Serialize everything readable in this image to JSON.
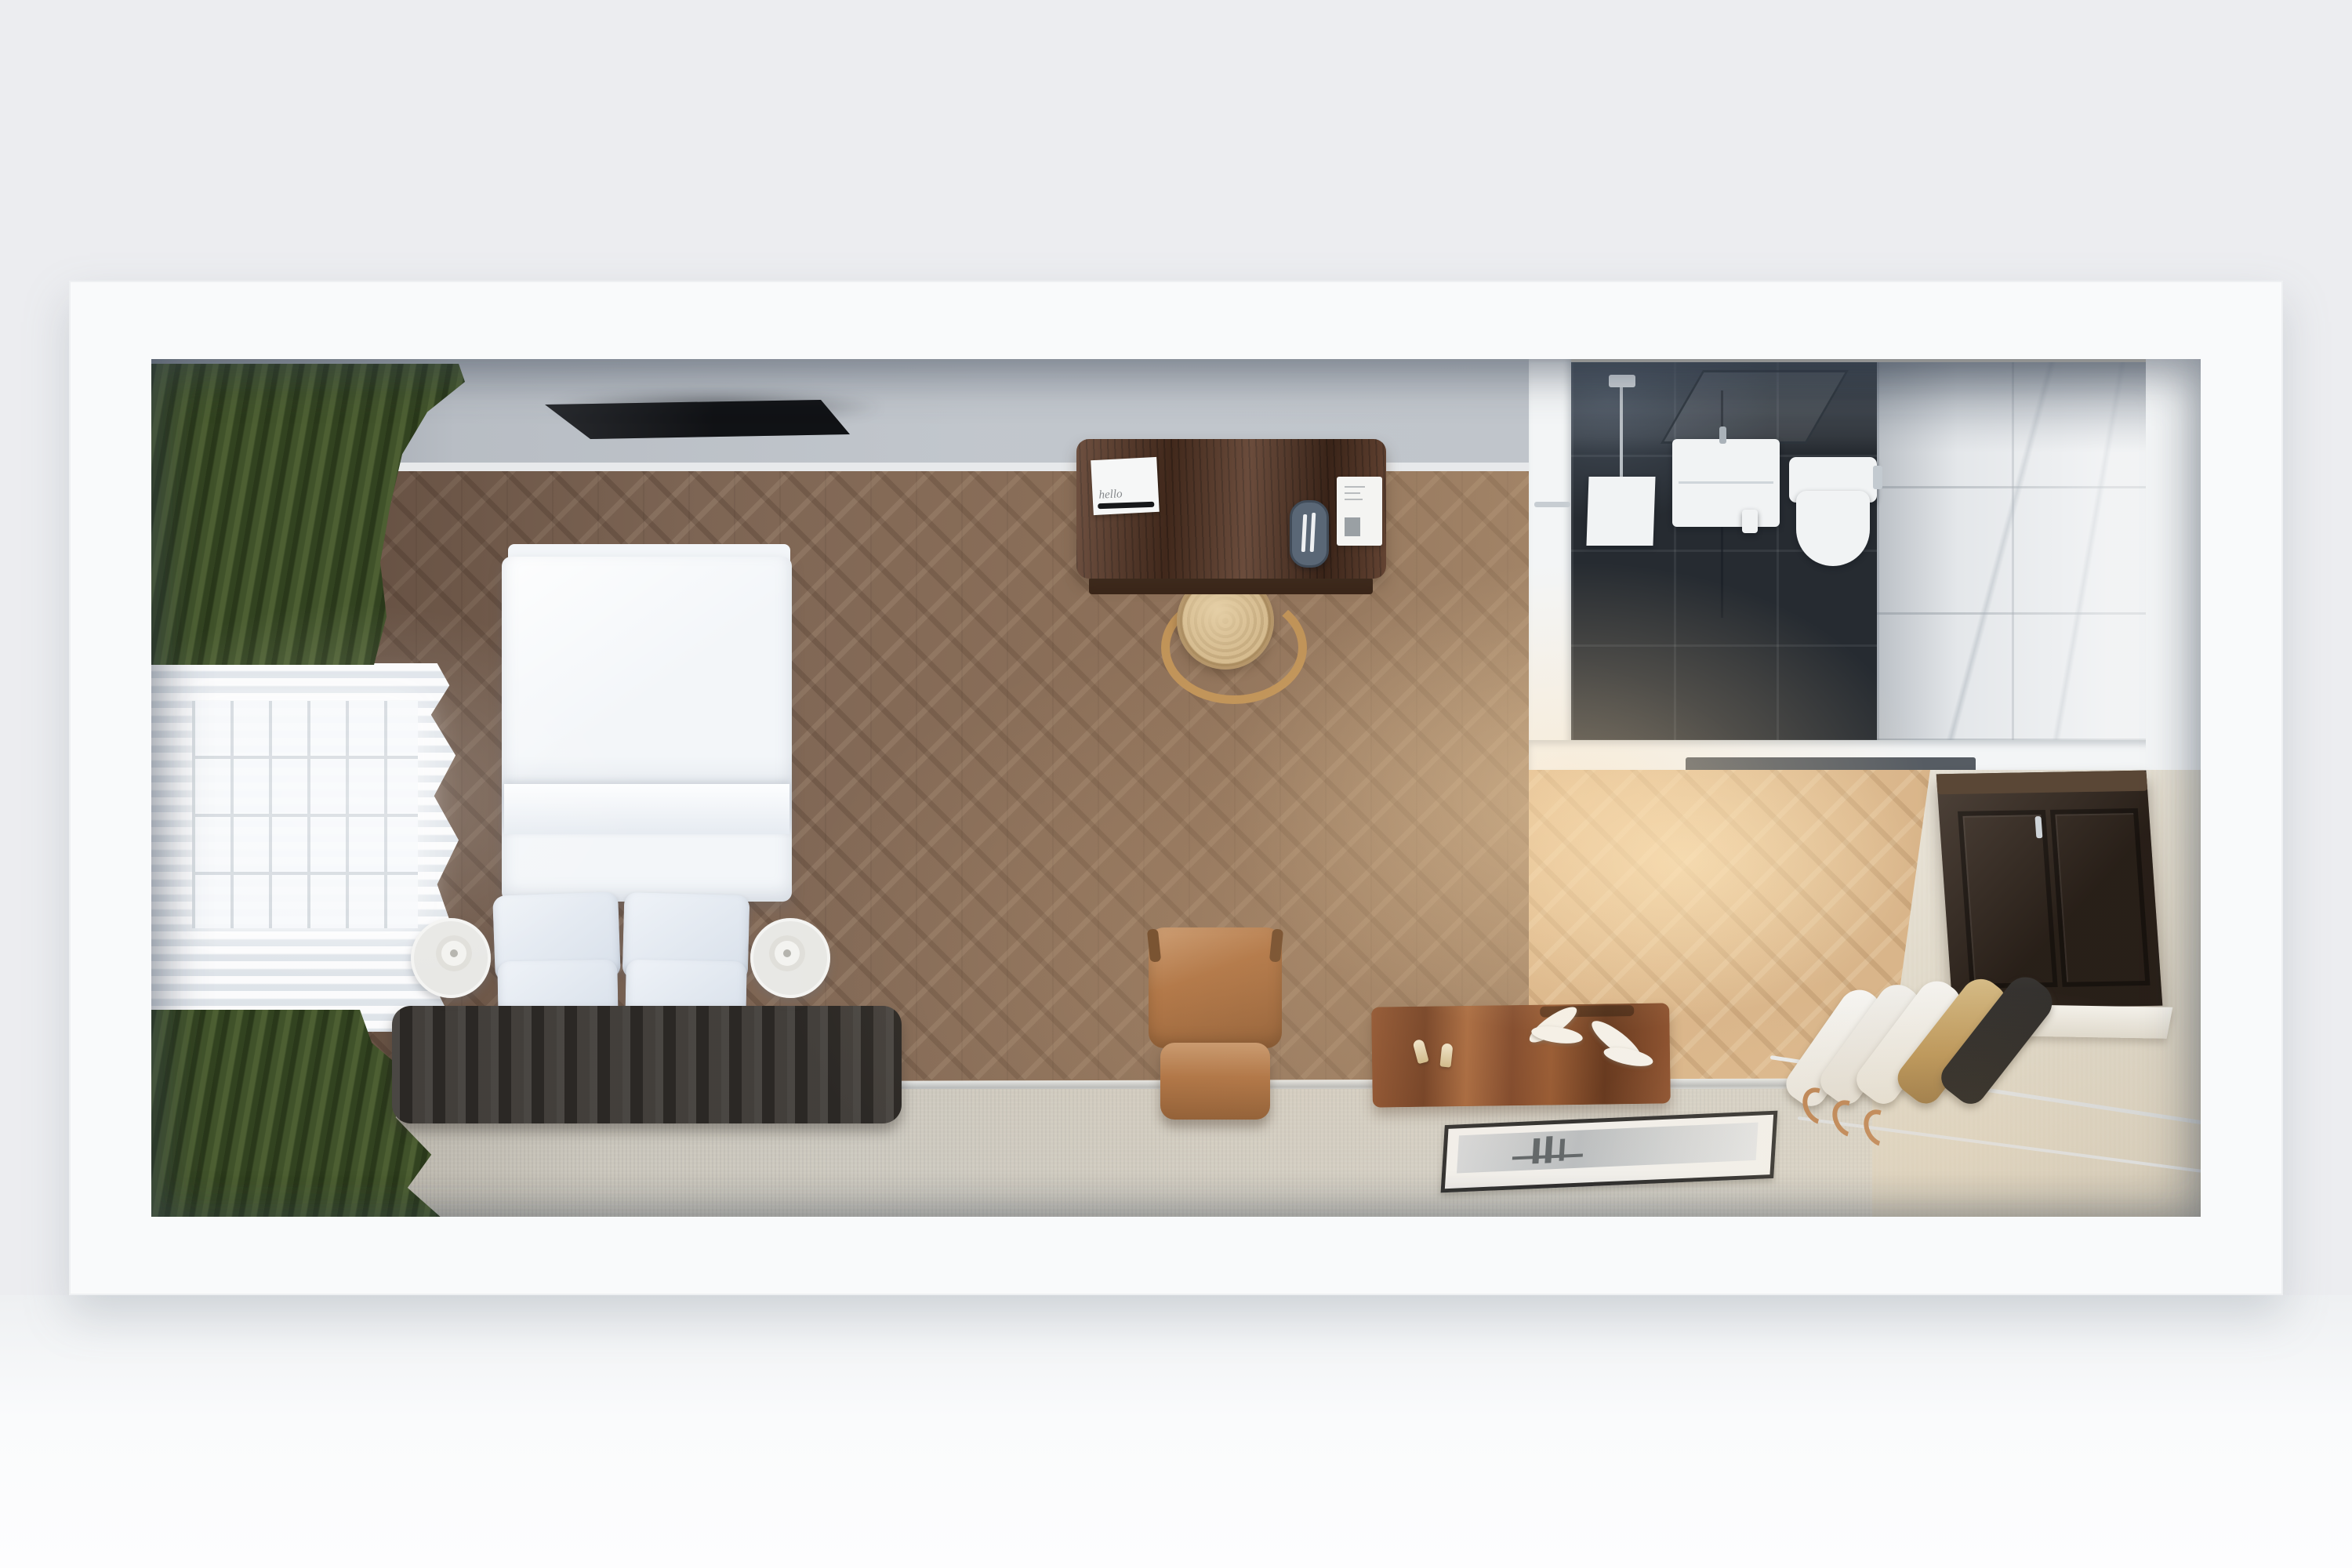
{
  "scene": {
    "type": "3d-floorplan-render",
    "view": "top-down overhead render",
    "description": "Overhead 3D render of a compact hotel guest room: bedroom with double bed and dark tufted headboard, green blackout curtains with sheer and window at left, wall-mounted TV, walnut work desk with rattan chair, en-suite bathroom with dark slate shower zone and white marble floor at top right, tan leather lounge chair, wooden storage bench with room keys and white coral, black-framed print leaning on the lower wall, espresso minibar cabinet and luggage rail with hanging garments at lower right",
    "visible_text": "hello"
  },
  "palette": {
    "page_bg": "#ecedf0",
    "wall_white": "#f9fafb",
    "north_wall": "#c0c5cb",
    "wood_floor": "#7d6554",
    "wood_floor_lit": "#d9b58a",
    "carpet": "#cac6bc",
    "accent_wall": "#e0d9c9",
    "curtain_green": "#41522b",
    "sheer_white": "#eef1f4",
    "tv_black": "#16181c",
    "desk_wood": "#5a3826",
    "rattan_seat": "#d5bb8f",
    "rattan_frame": "#c09358",
    "leather_tan": "#ab6f40",
    "duvet_white": "#f3f6f9",
    "pillow_blue": "#e2e9f1",
    "headboard_dark": "#3b3733",
    "nightstand_white": "#e8e8e5",
    "bath_tile_dark": "#262b31",
    "bath_marble": "#e4e7ea",
    "fixture_white": "#f1f3f4",
    "cabinet_espresso": "#3a2d23",
    "box_wood": "#7c4627",
    "garment_white": "#f3f2ee",
    "garment_gold": "#c3a065",
    "garment_black": "#242220",
    "metal_rail": "#dfe2e4",
    "hanger_tan": "#b97f4e"
  },
  "desk": {
    "notepad_text": "hello",
    "items": [
      "welcome notepad",
      "black pen",
      "oval tray with two white pens",
      "information booklet"
    ]
  },
  "bedroom": {
    "bed": "double bed with white duvet and four light-blue pillows",
    "headboard": "dark channel-tufted upholstered headboard",
    "nightstands": [
      "round white nightstand with disc lamp",
      "round white nightstand with disc lamp"
    ],
    "tv": "wall-mounted flat screen TV",
    "window": "window with grid mullions, white sheer and dark green curtains",
    "floor": "walnut herringbone parquet with beige carpet runner"
  },
  "bathroom": {
    "floors": [
      "dark slate tile shower zone",
      "white marble tile"
    ],
    "fixtures": [
      "ceiling rain shower with pipe",
      "white shower panel",
      "glass shelf frame",
      "wall-hung vanity sink",
      "wall-hung toilet",
      "flush plate",
      "toilet paper holder",
      "glass partition",
      "dark shower mat"
    ]
  },
  "lounge": {
    "chair": "tan leather lounge chair",
    "bench": "striped wooden storage bench",
    "keys": "two room keys with tags",
    "coral": "white coral decor pieces",
    "picture": "black-framed monochrome print leaning against the wall"
  },
  "wardrobe": {
    "cabinet": "espresso wall-mounted minibar cabinet with key",
    "ledge": "white shelf ledge",
    "rails": [
      "chrome luggage rail",
      "lower chrome rail"
    ],
    "garments": [
      "white garment",
      "white garment",
      "white garment",
      "gold garment bag",
      "black garment bag"
    ],
    "hangers": "wooden hanger hooks"
  }
}
